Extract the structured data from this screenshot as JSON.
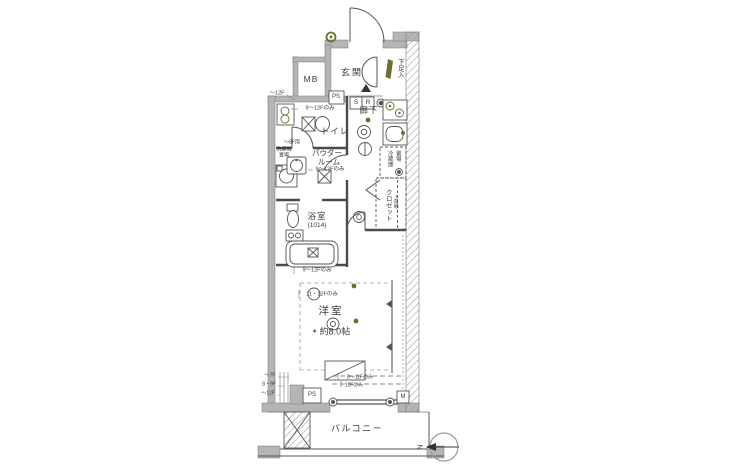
{
  "colors": {
    "wall": "#b5b5b5",
    "line": "#4a4a4a",
    "accent": "#6e6e2f",
    "text": "#3a3a3a"
  },
  "rooms": {
    "genkan": {
      "label": "玄関"
    },
    "shoe_box": {
      "label": "下足入"
    },
    "hallway": {
      "label": "廊下"
    },
    "toilet": {
      "label": "トイレ"
    },
    "powder_room": {
      "line1": "パウダー",
      "line2": "ルーム"
    },
    "bathroom": {
      "label": "浴室",
      "size": "(1014)"
    },
    "closet": {
      "label": "クロゼット",
      "shelf_note": "上段棚"
    },
    "fridge_space": {
      "line1": "冷蔵庫",
      "line2": "置場"
    },
    "washer_space": {
      "line1": "洗濯機",
      "line2": "置場",
      "floor_note": "〜8F用"
    },
    "western_room": {
      "label": "洋室",
      "size_marker": "✦",
      "size": "約8.0帖"
    },
    "balcony": {
      "label": "バルコニー"
    }
  },
  "service_boxes": {
    "mb": "MB",
    "ps_upper": "PS",
    "ps_lower": "PS",
    "s": "S",
    "r": "R",
    "m": "M"
  },
  "floor_annotations": {
    "left_top": "〜12F",
    "toilet": "9〜12Fのみ",
    "powder": "9〜12Fのみ",
    "room_upper": "9〜12Fのみ",
    "room_lower": "11・12Fのみ",
    "window_upper": "8〜11Fのみ",
    "window_lower": "12Fのみ",
    "wall_1": "〜7F",
    "wall_2": "8・9F",
    "wall_3": "〜12F"
  },
  "compass": {
    "north": "N"
  }
}
